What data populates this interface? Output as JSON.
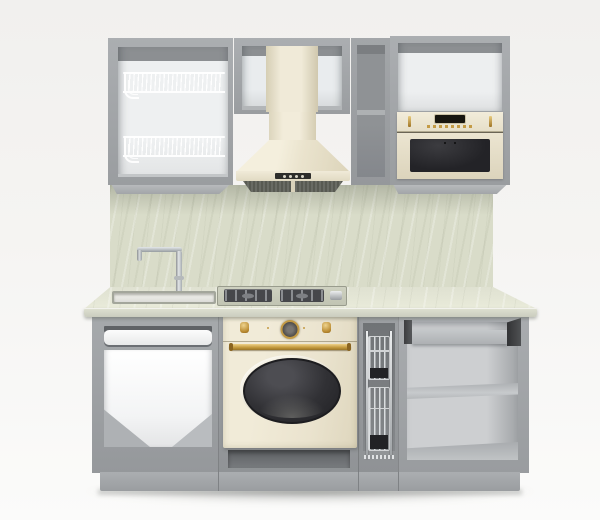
{
  "image": {
    "type": "3d-product-render",
    "subject": "Straight modular kitchen set, front view, on a plain light studio background",
    "background": "#f4f3f1",
    "visible_text": ""
  },
  "palette": {
    "carcass_gray": "#9a9da0",
    "carcass_gray_light": "#abaeb1",
    "carcass_gray_dark": "#85888b",
    "interior_white": "#f0f1f2",
    "interior_shadow": "#8c8f92",
    "cream": "#ece5d0",
    "cream_dark": "#d6cdb2",
    "cream_light": "#f4efe0",
    "brass": "#c49b45",
    "brass_light": "#e8cc80",
    "chrome": "#c7cacc",
    "steel_dark": "#46474b",
    "glass_dark": "#29292c",
    "marble_backsplash": "#d9dcc9",
    "marble_counter": "#e3e5d5",
    "wire_white": "#ffffff",
    "plinth_gray": "#a7aaad",
    "recess_dark": "#6f7275"
  },
  "scene": {
    "wall_row": {
      "dish_cabinet": {
        "description": "open gray wall cabinet, white interior",
        "dish_rack_tiers": 2,
        "rack_color": "white wire"
      },
      "hood_cabinet": {
        "description": "open gray wall cabinet housing hood chimney"
      },
      "range_hood": {
        "style": "pyramid chimney hood",
        "finish": "cream",
        "control_buttons": 4,
        "grease_filters": 2
      },
      "narrow_cabinet": {
        "description": "narrow open gray wall cabinet",
        "shelves": 1
      },
      "microwave_cabinet": {
        "description": "gray wall cabinet, open top niche, microwave below"
      },
      "microwave": {
        "style": "retro built-in",
        "finish": "cream",
        "display": "dark digital display",
        "controls": "row of small brass buttons, two brass accents",
        "door": "dark glass"
      }
    },
    "mid_zone": {
      "backsplash": "light sage marble panel",
      "faucet": "chrome single-lever, L-shaped spout",
      "sink": "white inset sink bowl",
      "cooktop": {
        "type": "gas",
        "burners": 2,
        "grates": "dark cast",
        "side_control": "chrome knob"
      }
    },
    "base_row": {
      "sink_cabinet": {
        "description": "open gray base cabinet under sink",
        "drawer_fronts": "one white front bar"
      },
      "oven": {
        "style": "retro",
        "finish": "cream",
        "knobs": 2,
        "clock": "central analog timer with brass ring",
        "handle": "brass bar",
        "window": "oval dark glass",
        "under_oven": "open dark recess"
      },
      "pullout_cabinet": {
        "description": "narrow pull-out unit",
        "basket_tiers": 2,
        "basket_material": "chrome wire with dark trays"
      },
      "open_cabinet": {
        "description": "open gray base cabinet",
        "shelves": 2,
        "top": "pull-out shelf on dark runners"
      }
    },
    "plinth": "continuous gray toe-kick with seams",
    "floor": "soft contact shadow under plinth"
  }
}
